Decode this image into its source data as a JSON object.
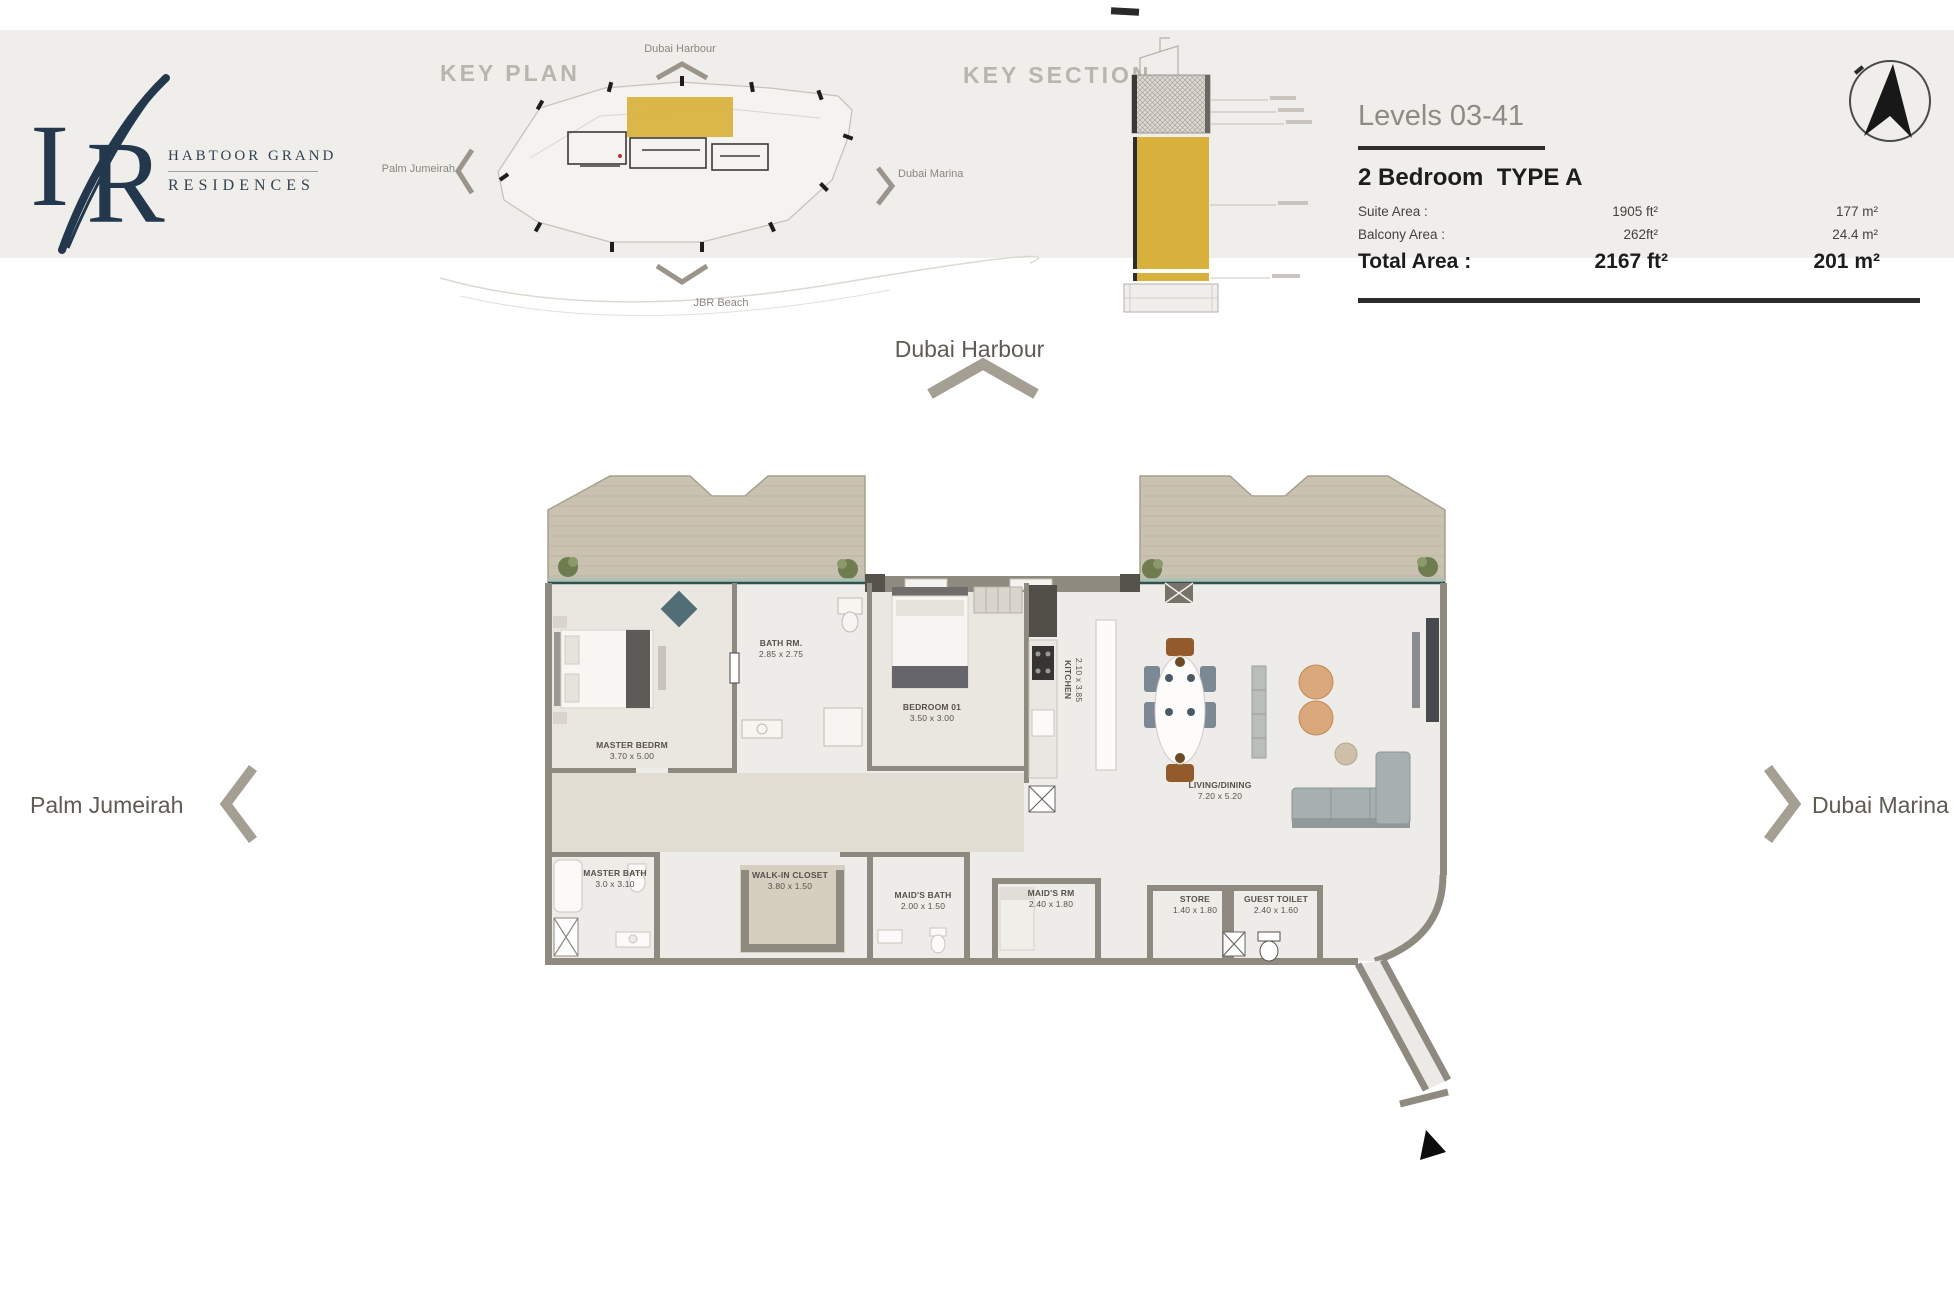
{
  "brand": {
    "monogram_left": "I",
    "monogram_right": "R",
    "line1": "HABTOOR GRAND",
    "line2": "RESIDENCES"
  },
  "key_plan": {
    "title": "KEY PLAN",
    "top": "Dubai Harbour",
    "left": "Palm Jumeirah",
    "right": "Dubai Marina",
    "bottom": "JBR Beach"
  },
  "key_section": {
    "title": "KEY SECTION"
  },
  "info": {
    "levels": "Levels 03-41",
    "unit_type": "2 Bedroom  TYPE A",
    "rows": [
      {
        "label": "Suite Area :",
        "ft": "1905 ft²",
        "m": "177 m²"
      },
      {
        "label": "Balcony Area :",
        "ft": "262ft²",
        "m": "24.4 m²"
      }
    ],
    "total": {
      "label": "Total Area :",
      "ft": "2167 ft²",
      "m": "201 m²"
    }
  },
  "plan_labels": {
    "top": "Dubai Harbour",
    "left": "Palm Jumeirah",
    "right": "Dubai Marina"
  },
  "rooms": [
    {
      "name": "MASTER BEDRM",
      "dims": "3.70 x 5.00"
    },
    {
      "name": "BATH RM.",
      "dims": "2.85 x 2.75"
    },
    {
      "name": "BEDROOM 01",
      "dims": "3.50 x 3.00"
    },
    {
      "name": "KITCHEN",
      "dims": "2.10 x 3.85"
    },
    {
      "name": "LIVING/DINING",
      "dims": "7.20 x 5.20"
    },
    {
      "name": "MASTER BATH",
      "dims": "3.0 x 3.10"
    },
    {
      "name": "WALK-IN CLOSET",
      "dims": "3.80 x 1.50"
    },
    {
      "name": "MAID'S BATH",
      "dims": "2.00 x 1.50"
    },
    {
      "name": "MAID'S RM",
      "dims": "2.40 x 1.80"
    },
    {
      "name": "STORE",
      "dims": "1.40 x 1.80"
    },
    {
      "name": "GUEST TOILET",
      "dims": "2.40 x 1.60"
    }
  ],
  "colors": {
    "gold": "#d8b13d",
    "navy": "#23384c",
    "header_bg": "#efeeeb"
  }
}
